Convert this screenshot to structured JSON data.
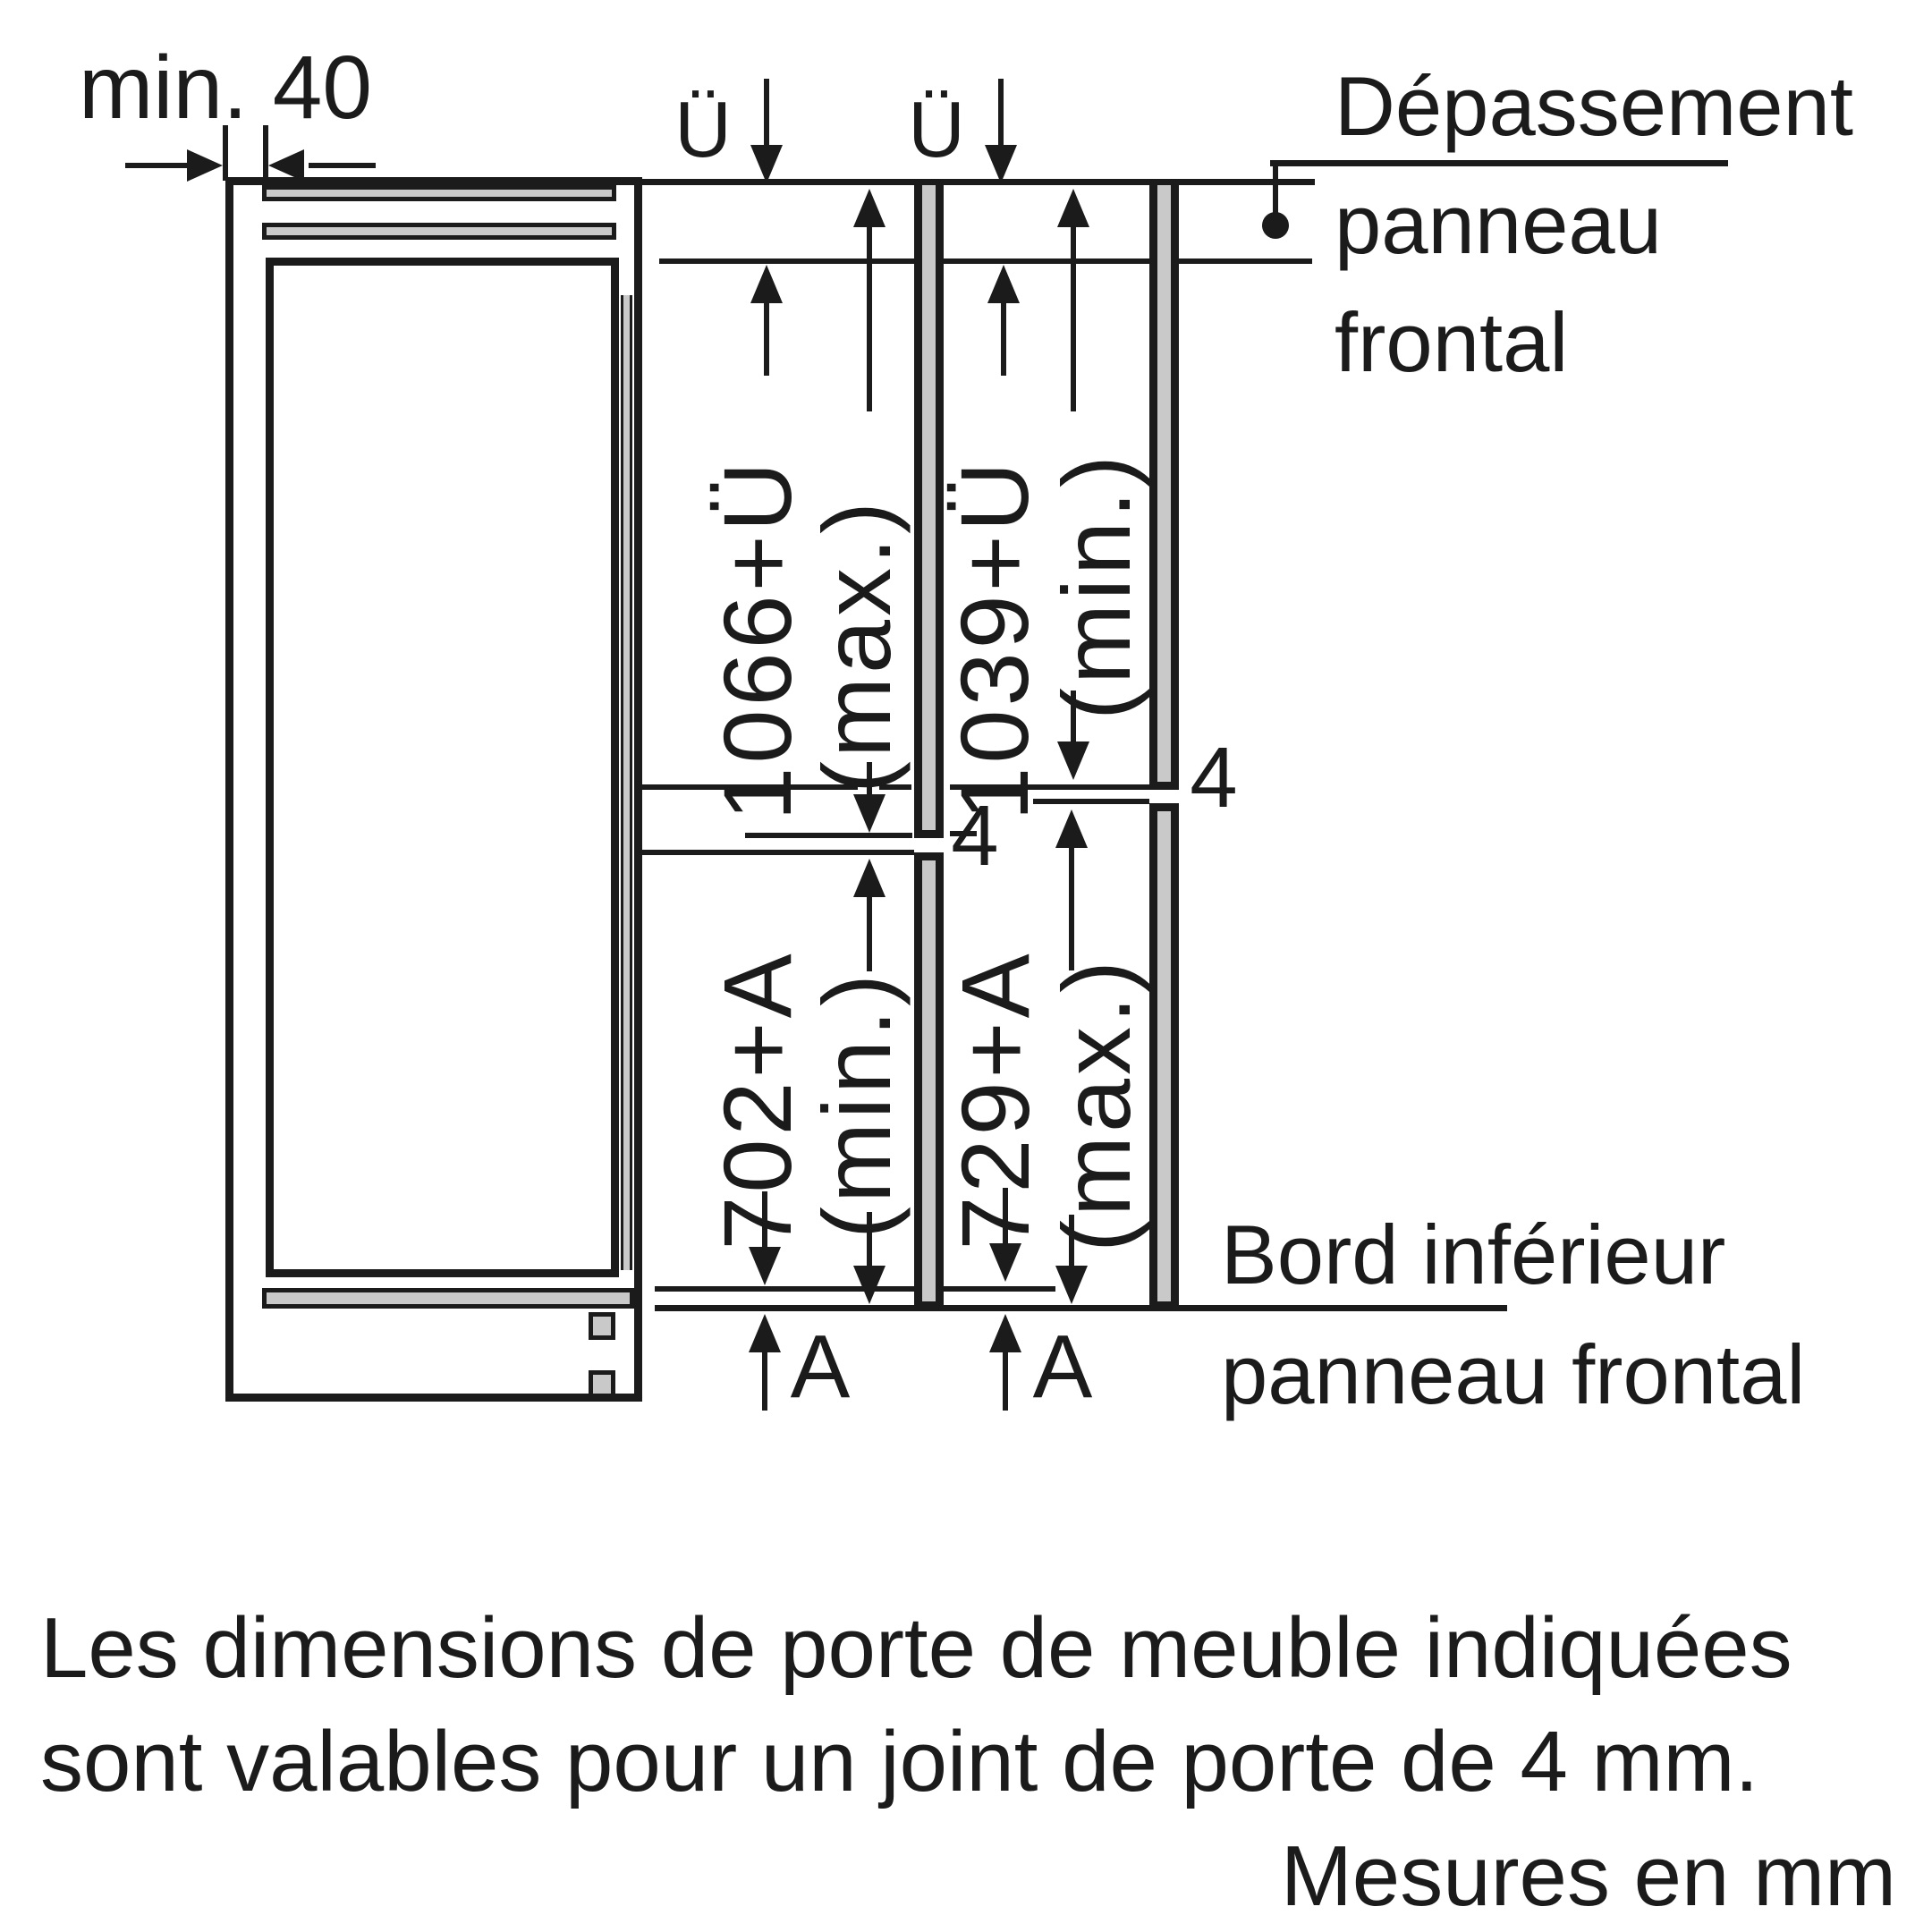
{
  "colors": {
    "ink": "#1b1b1b",
    "panel_gray": "#c9c9c9",
    "background": "#ffffff"
  },
  "diagram": {
    "wall_clearance_label": "min. 40",
    "overhang": {
      "left_label": "Ü",
      "right_label": "Ü"
    },
    "upper_door": {
      "max_value": "1066+Ü",
      "max_qualifier": "(max.)",
      "min_value": "1039+Ü",
      "min_qualifier": "(min.)"
    },
    "lower_door": {
      "min_value": "702+A",
      "min_qualifier": "(min.)",
      "max_value": "729+A",
      "max_qualifier": "(max.)"
    },
    "joint_gap": {
      "left": "4",
      "right": "4"
    },
    "bottom_offset": {
      "left": "A",
      "right": "A"
    },
    "callouts": {
      "front_panel_overhang": [
        "Dépassement",
        "panneau",
        "frontal"
      ],
      "front_panel_lower_edge": [
        "Bord inférieur",
        "panneau frontal"
      ]
    }
  },
  "footer": {
    "note_line1": "Les dimensions de porte de meuble indiquées",
    "note_line2": "sont valables pour un joint de porte de 4 mm.",
    "units_note": "Mesures en mm"
  }
}
